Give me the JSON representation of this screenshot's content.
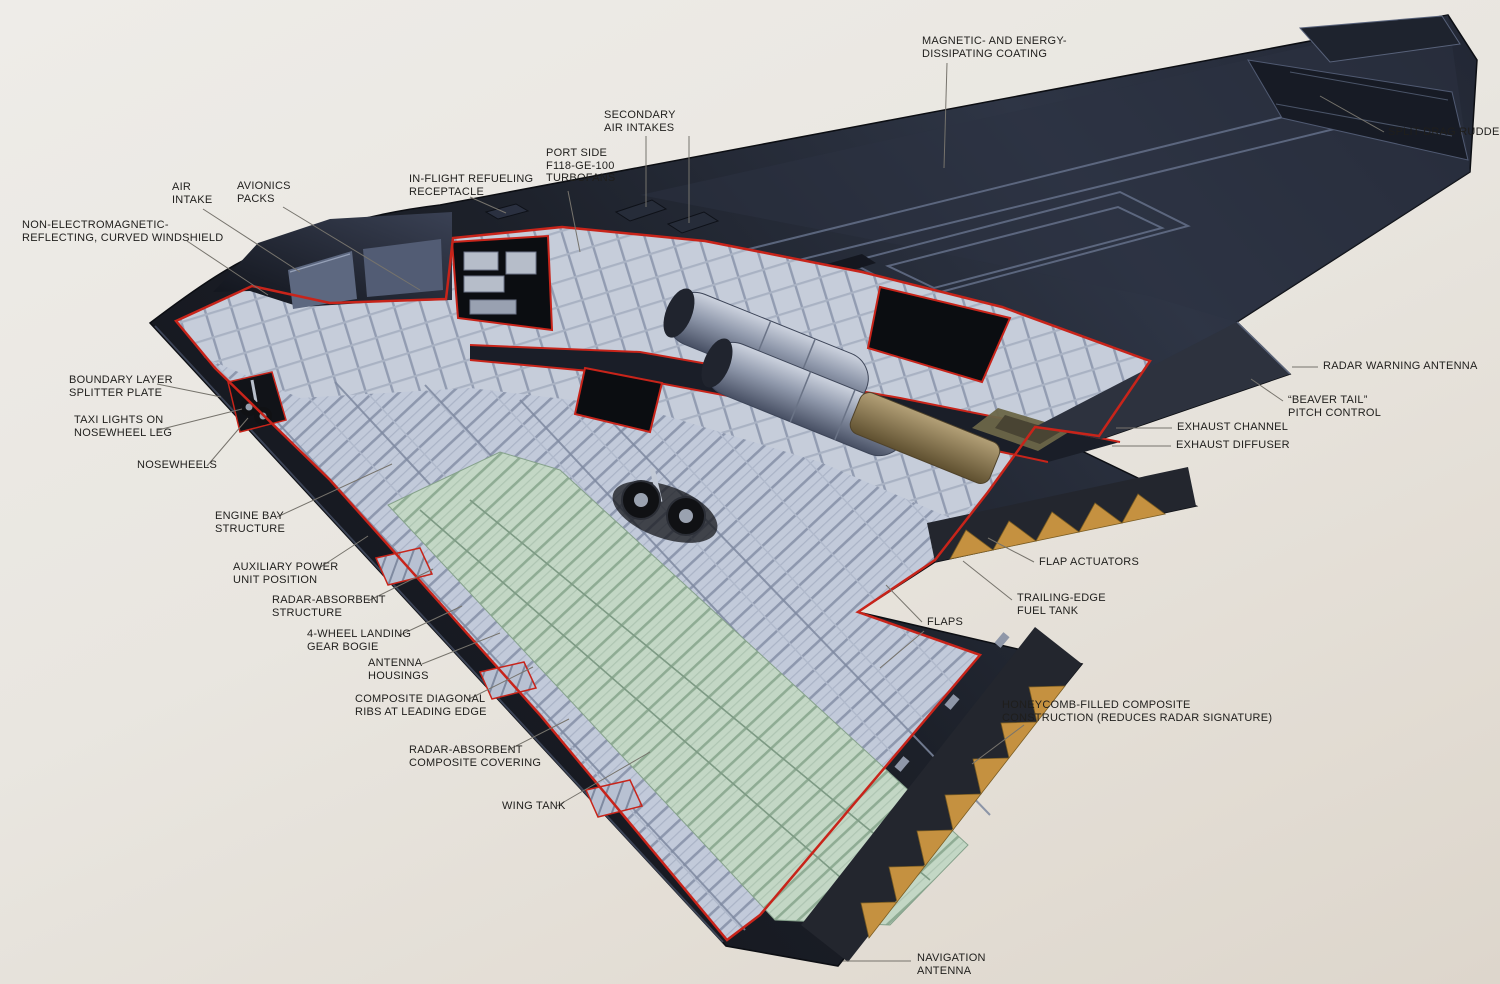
{
  "labels": {
    "magnetic_coating": {
      "l1": "MAGNETIC- AND ENERGY-",
      "l2": "DISSIPATING COATING"
    },
    "split_drag_rudder": {
      "l1": "SPLIT-DRAG RUDDER"
    },
    "secondary_intakes": {
      "l1": "SECONDARY",
      "l2": "AIR INTAKES"
    },
    "port_turbofans": {
      "l1": "PORT SIDE",
      "l2": "F118-GE-100",
      "l3": "TURBOFANS"
    },
    "inflight_refueling": {
      "l1": "IN-FLIGHT REFUELING",
      "l2": "RECEPTACLE"
    },
    "air_intake": {
      "l1": "AIR",
      "l2": "INTAKE"
    },
    "avionics_packs": {
      "l1": "AVIONICS",
      "l2": "PACKS"
    },
    "windshield": {
      "l1": "NON-ELECTROMAGNETIC-",
      "l2": "REFLECTING, CURVED WINDSHIELD"
    },
    "boundary_layer": {
      "l1": "BOUNDARY LAYER",
      "l2": "SPLITTER PLATE"
    },
    "taxi_lights": {
      "l1": "TAXI LIGHTS ON",
      "l2": "NOSEWHEEL LEG"
    },
    "nosewheels": {
      "l1": "NOSEWHEELS"
    },
    "engine_bay": {
      "l1": "ENGINE BAY",
      "l2": "STRUCTURE"
    },
    "apu": {
      "l1": "AUXILIARY POWER",
      "l2": "UNIT POSITION"
    },
    "radar_absorbent_structure": {
      "l1": "RADAR-ABSORBENT",
      "l2": "STRUCTURE"
    },
    "gear_bogie": {
      "l1": "4-WHEEL LANDING",
      "l2": "GEAR BOGIE"
    },
    "antenna_housings": {
      "l1": "ANTENNA",
      "l2": "HOUSINGS"
    },
    "composite_ribs": {
      "l1": "COMPOSITE DIAGONAL",
      "l2": "RIBS AT LEADING EDGE"
    },
    "rac_covering": {
      "l1": "RADAR-ABSORBENT",
      "l2": "COMPOSITE COVERING"
    },
    "wing_tank": {
      "l1": "WING TANK"
    },
    "radar_warning": {
      "l1": "RADAR WARNING ANTENNA"
    },
    "beaver_tail": {
      "l1": "“BEAVER TAIL”",
      "l2": "PITCH CONTROL"
    },
    "exhaust_channel": {
      "l1": "EXHAUST CHANNEL"
    },
    "exhaust_diffuser": {
      "l1": "EXHAUST DIFFUSER"
    },
    "flap_actuators": {
      "l1": "FLAP ACTUATORS"
    },
    "trailing_edge_tank": {
      "l1": "TRAILING-EDGE",
      "l2": "FUEL TANK"
    },
    "flaps": {
      "l1": "FLAPS"
    },
    "honeycomb": {
      "l1": "HONEYCOMB-FILLED COMPOSITE",
      "l2": "CONSTRUCTION (REDUCES RADAR SIGNATURE)"
    },
    "navigation_antenna": {
      "l1": "NAVIGATION",
      "l2": "ANTENNA"
    }
  },
  "colors": {
    "background": "#e9e6e0",
    "label_ink": "#1f1e1c",
    "leader_gray": "#76736c",
    "cut_outline_red": "#c8241a",
    "airframe_dark": "#171a23",
    "structure_light": "#c2cada",
    "tank_green": "#c3d7c5",
    "honeycomb_tan": "#c59140"
  }
}
